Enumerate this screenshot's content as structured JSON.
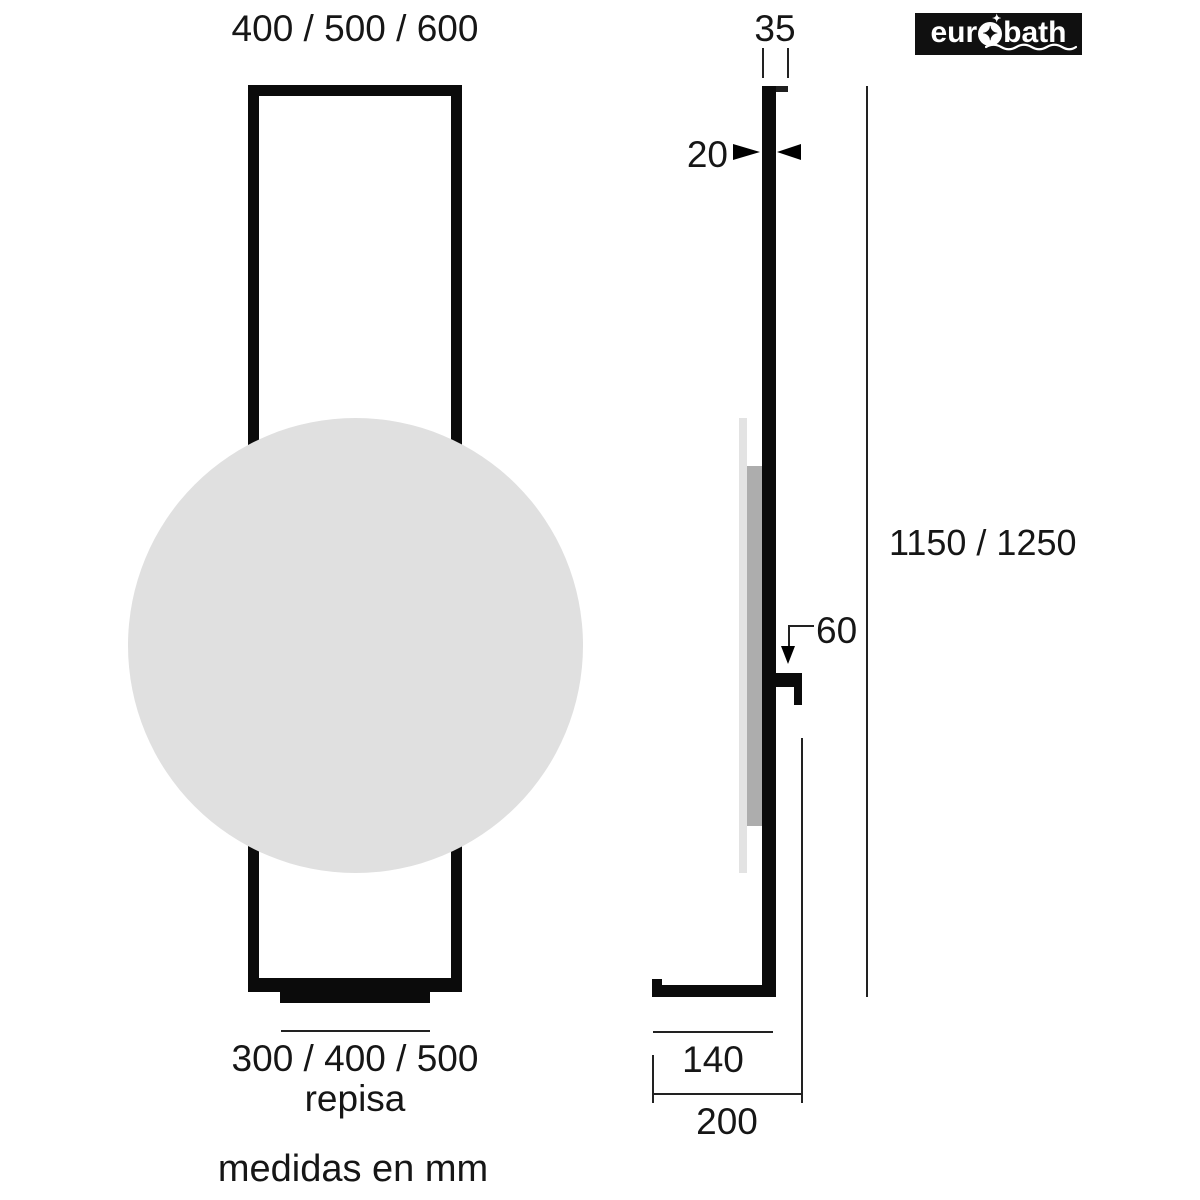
{
  "meta": {
    "units_note": "medidas en mm"
  },
  "logo": {
    "text_left": "eur",
    "text_right": "bath",
    "star_glyph": "✦",
    "sparkle_glyph": "✦"
  },
  "front_view": {
    "width_label": "400 / 500 / 600",
    "shelf_width_label": "300 / 400 / 500",
    "shelf_label": "repisa"
  },
  "side_view": {
    "top_depth_label": "35",
    "thickness_label": "20",
    "height_label": "1150 / 1250",
    "shelf_drop_label": "60",
    "foot_depth_label": "140",
    "total_depth_label": "200"
  },
  "colors": {
    "line": "#0b0b0b",
    "mirror_fill": "#e0e0e0",
    "glass_edge": "#e3e3e3",
    "backing": "#adadad",
    "logo_bg": "#101010",
    "logo_fg": "#ffffff"
  }
}
